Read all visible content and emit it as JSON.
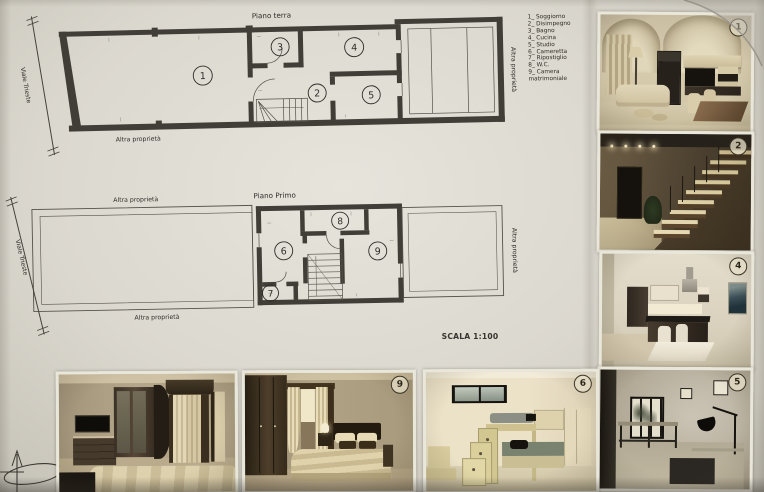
{
  "sheet": {
    "scale_label": "SCALA 1:100"
  },
  "legend": {
    "items": [
      "1_ Soggiorno",
      "2_ Disimpegno",
      "3_ Bagno",
      "4_ Cucina",
      "5_ Studio",
      "6_ Cameretta",
      "7_ Ripostiglio",
      "8_ W.C.",
      "9_ Camera matrimoniale"
    ]
  },
  "plans": {
    "ground": {
      "title": "Piano terra",
      "street_label": "Viale Trieste",
      "bottom_label": "Altra proprietà",
      "right_label": "Altra proprietà",
      "rooms": {
        "soggiorno": "1",
        "disimpegno": "2",
        "bagno": "3",
        "cucina": "4",
        "studio": "5"
      }
    },
    "first": {
      "title": "Piano Primo",
      "top_label": "Altra proprietà",
      "street_label": "Viale Trieste",
      "bottom_label": "Altra proprietà",
      "right_label": "Altra proprietà",
      "rooms": {
        "cameretta": "6",
        "ripostiglio": "7",
        "wc": "8",
        "camera_matrimoniale": "9"
      }
    }
  },
  "photos": {
    "right_column_badges": [
      "1",
      "2",
      "4",
      "5"
    ],
    "bottom_row_badges": [
      null,
      "9",
      "6"
    ]
  },
  "colors": {
    "wall": "#413e38",
    "paper": "#d9d6cd",
    "ink": "#2e2c28"
  }
}
